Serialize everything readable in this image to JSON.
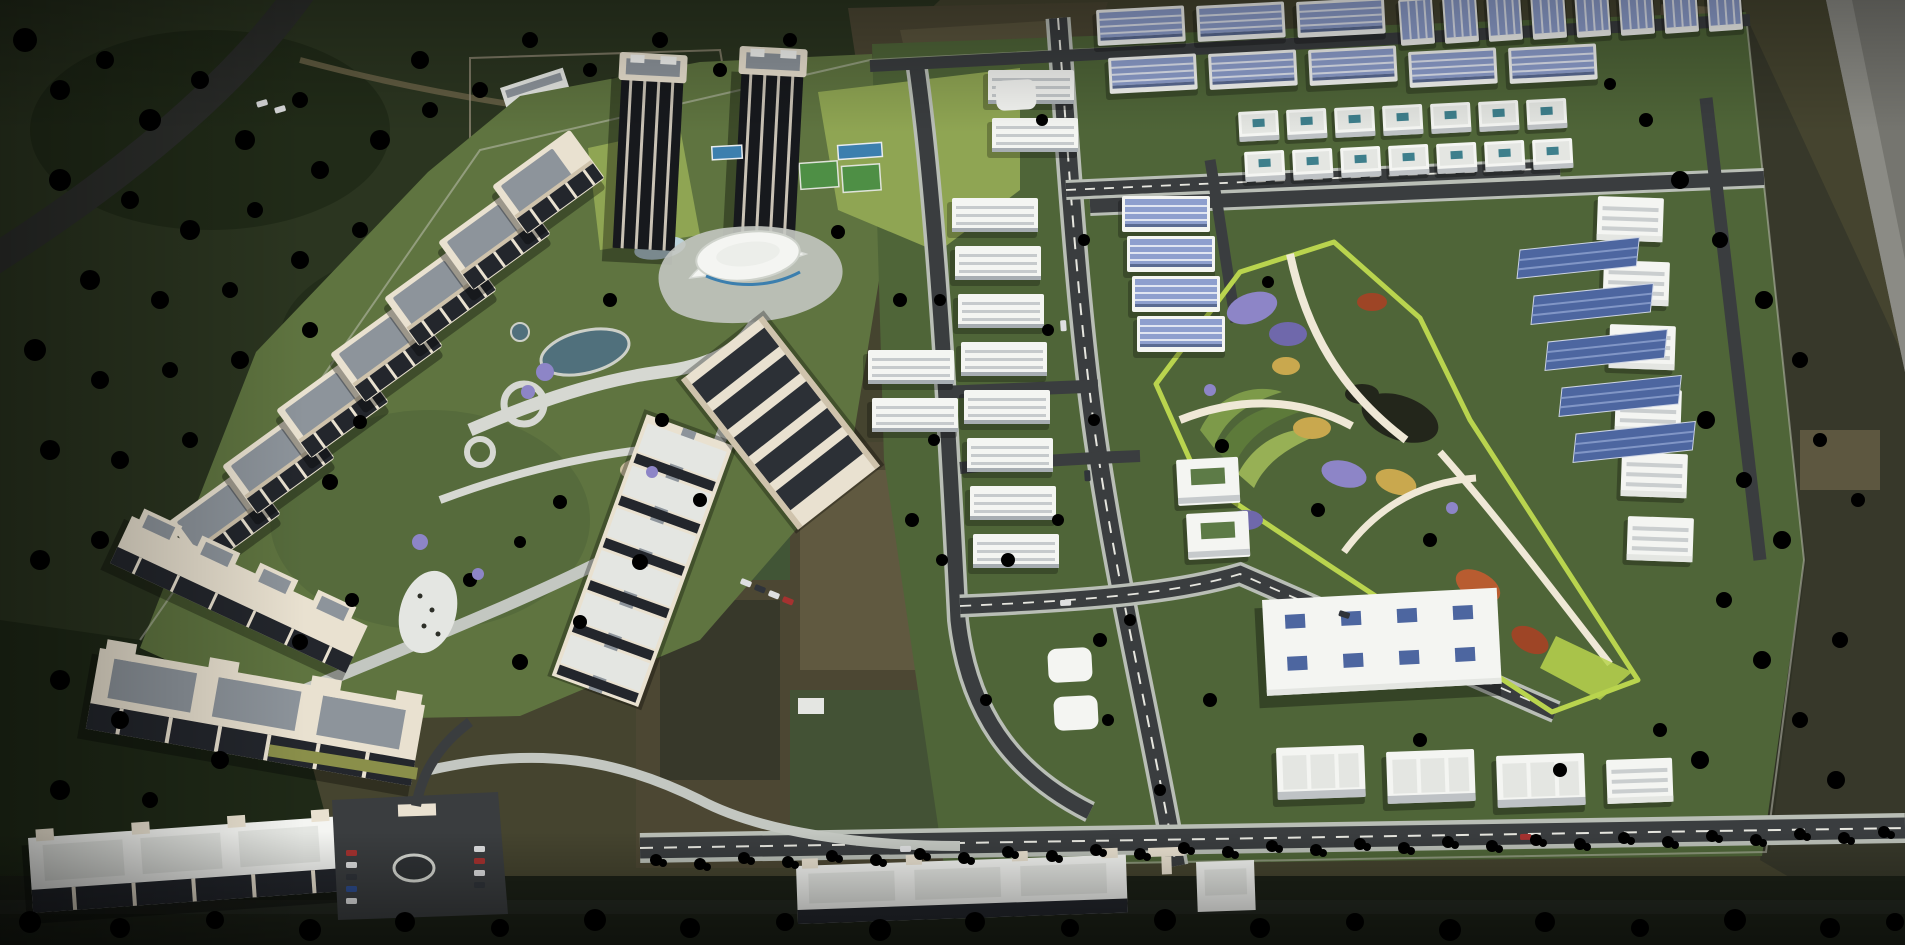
{
  "meta": {
    "title": "Township masterplan aerial 3D render",
    "image_type": "architectural-visualization",
    "view": "high-angle aerial, dusk lighting, no visible text or UI"
  },
  "palette": {
    "terrain": "#45442f",
    "forest": "#2b3520",
    "forestDeep": "#1f2917",
    "grass": "#5f7440",
    "grassDeep": "#4f6538",
    "lawnBright": "#8fa553",
    "fieldBrown": "#4c4733",
    "fieldTan": "#6e654a",
    "fieldDark": "#37382a",
    "fieldGreen": "#415536",
    "road": "#3a3d3f",
    "roadDark": "#2c2e2b",
    "roadLine": "#e6e6df",
    "sidewalk": "#b9beb6",
    "plaza": "#c3c7c1",
    "pathLight": "#d6d8d2",
    "cream": "#e9e1d0",
    "creamDark": "#cfc3ac",
    "white": "#f4f5f2",
    "offWhite": "#e4e6e2",
    "roofGray": "#a7adb2",
    "roofSlate": "#8d949b",
    "windowDark": "#23262c",
    "darkFacade": "#17191d",
    "solarBlue": "#8e9fce",
    "solarDeep": "#4d66a0",
    "teal": "#3e7f8c",
    "poolBlue": "#3c7fae",
    "parkSand": "#dbd2b6",
    "parkLime": "#b9d44e",
    "sandPath": "#efe8d6",
    "flowerPurple": "#8d85c7",
    "flowerViolet": "#6f68ab",
    "flowerOrange": "#b85c30",
    "flowerRust": "#9e4526",
    "flowerYellow": "#c9a84e",
    "pondDark": "#23261b",
    "grayBand": "#75756f",
    "grayBandLight": "#8b8b85",
    "bottomStrip": "#1c2117",
    "wallLine": "#c6c6ba",
    "carRed": "#a53230",
    "carWhite": "#dedfe0",
    "carBlue": "#2e4d8e",
    "carDark": "#30343a"
  },
  "scene": {
    "surroundings": [
      "dense tree cover and dark scrub on the north-west",
      "diagonal rural road leaving the top-left corner",
      "walled vacant compound with two grey sheds near the towers",
      "dry farm plots north and east of the township",
      "grey paved strip clipping the top-right corner",
      "dark tree-lined belt across the bottom edge"
    ],
    "zones": [
      {
        "name": "highrise-staircase-cluster",
        "towers": 7,
        "style": "cream towers stepping diagonally, dark glazed faces, grey roof decks"
      },
      {
        "name": "terraced-slab-blocks",
        "blocks": 3,
        "style": "long cream low-rise slabs with rooftop unit frames"
      },
      {
        "name": "twin-dark-towers",
        "towers": 2,
        "amenities": [
          "blue pool strip",
          "lap pool",
          "green sports courts",
          "bright lawns"
        ]
      },
      {
        "name": "clubhouse",
        "style": "white oval roof with curved wings and paved plaza"
      },
      {
        "name": "diagonal-slab-towers",
        "towers": 2,
        "style": "one with dark solar-striped roof"
      },
      {
        "name": "white-slab-stacks",
        "slabs": 10
      },
      {
        "name": "shed-villa-column",
        "units": 4
      },
      {
        "name": "solar-roof-shed-rows",
        "sheds": 22
      },
      {
        "name": "villa-grid",
        "rows": 2,
        "perRow": 7
      },
      {
        "name": "right-slab-column",
        "slabs": 6
      },
      {
        "name": "solar-panel-arrays",
        "count": 5
      },
      {
        "name": "central-park",
        "features": [
          "lime-green border",
          "sandy ground",
          "purple, orange and yellow flower beds",
          "curved lawn bands",
          "dark pond",
          "winding paths"
        ]
      },
      {
        "name": "school-block",
        "skylights": 8
      },
      {
        "name": "raw-earth-plot",
        "style": "unbuilt dark field beside the park"
      },
      {
        "name": "bottom-apartment-slabs",
        "slabs": 3
      },
      {
        "name": "entrance-gate",
        "features": [
          "gatehouse",
          "oval roundabout",
          "visitor parking with parked cars"
        ]
      },
      {
        "name": "palm-boulevard",
        "style": "palm-lined avenue along the southern edge"
      }
    ],
    "vehicles": "small cars on internal roads and in the entrance parking",
    "lighting": "low warm light from the upper right, long soft shadows to the lower left"
  }
}
